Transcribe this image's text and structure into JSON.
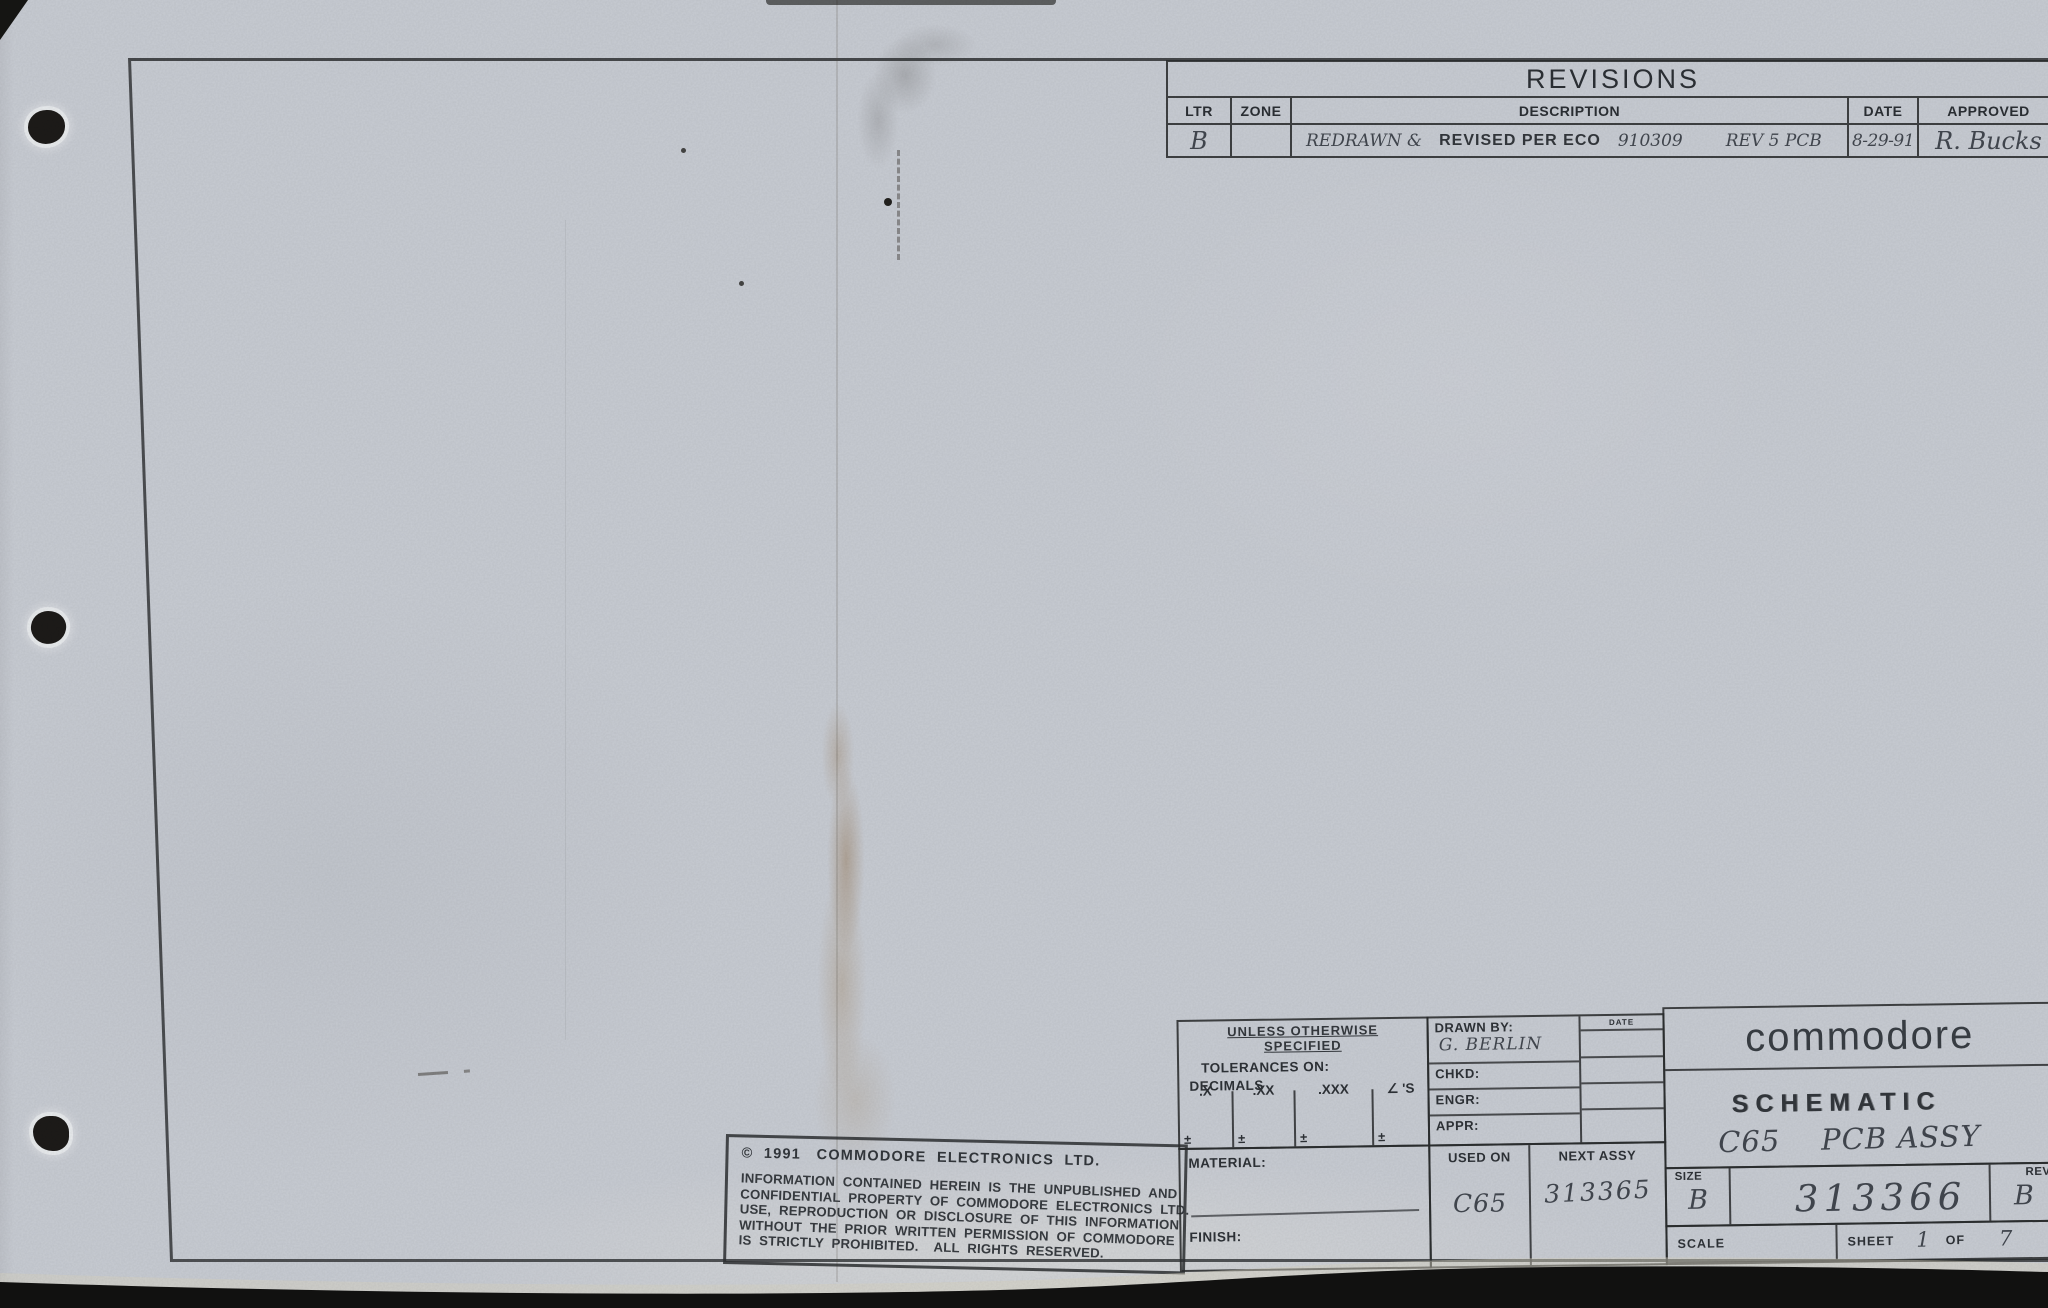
{
  "colors": {
    "paper": "#c8ccd3",
    "ink": "#2e3237",
    "pencil": "#42474f",
    "frame_line": "#303234",
    "scanner_bed": "#111110"
  },
  "revisions": {
    "title": "REVISIONS",
    "headers": {
      "ltr": "LTR",
      "zone": "ZONE",
      "description": "DESCRIPTION",
      "date": "DATE",
      "approved": "APPROVED"
    },
    "row": {
      "ltr": "B",
      "zone": "",
      "desc_hand_prefix": "REDRAWN &",
      "desc_typed": "REVISED PER ECO",
      "desc_hand_number": "910309",
      "desc_hand_suffix": "REV 5 PCB",
      "date": "8-29-91",
      "approved": "R. Bucks"
    }
  },
  "copyright": {
    "line1": "©  1991   COMMODORE  ELECTRONICS  LTD.",
    "body": [
      "INFORMATION  CONTAINED  HEREIN  IS  THE  UNPUBLISHED  AND",
      "CONFIDENTIAL  PROPERTY  OF  COMMODORE  ELECTRONICS  LTD.",
      "USE,  REPRODUCTION  OR  DISCLOSURE  OF  THIS  INFORMATION",
      "WITHOUT  THE  PRIOR  WRITTEN  PERMISSION  OF  COMMODORE",
      "IS  STRICTLY  PROHIBITED.    ALL  RIGHTS  RESERVED."
    ]
  },
  "tolerances": {
    "heading1": "UNLESS OTHERWISE",
    "heading2": "SPECIFIED",
    "sub": "TOLERANCES ON:",
    "group": "DECIMALS",
    "cols": [
      ".X",
      ".XX",
      ".XXX",
      "∠ 'S"
    ],
    "pm": "±"
  },
  "approvals": {
    "date_header": "DATE",
    "drawn_label": "DRAWN BY:",
    "drawn_value": "G. BERLIN",
    "chkd_label": "CHKD:",
    "engr_label": "ENGR:",
    "appr_label": "APPR:"
  },
  "material": {
    "material_label": "MATERIAL:",
    "finish_label": "FINISH:"
  },
  "usage": {
    "used_on_header": "USED ON",
    "used_on_value": "C65",
    "next_assy_header": "NEXT ASSY",
    "next_assy_value": "313365"
  },
  "titleblock": {
    "logo": "commodore",
    "doc_type": "SCHEMATIC",
    "doc_title": "C65    PCB ASSY",
    "size_label": "SIZE",
    "size_value": "B",
    "drawing_number": "313366",
    "rev_label": "REV",
    "rev_value": "B",
    "scale_label": "SCALE",
    "sheet_label": "SHEET",
    "sheet_number": "1",
    "of_label": "OF",
    "sheet_total": "7"
  }
}
